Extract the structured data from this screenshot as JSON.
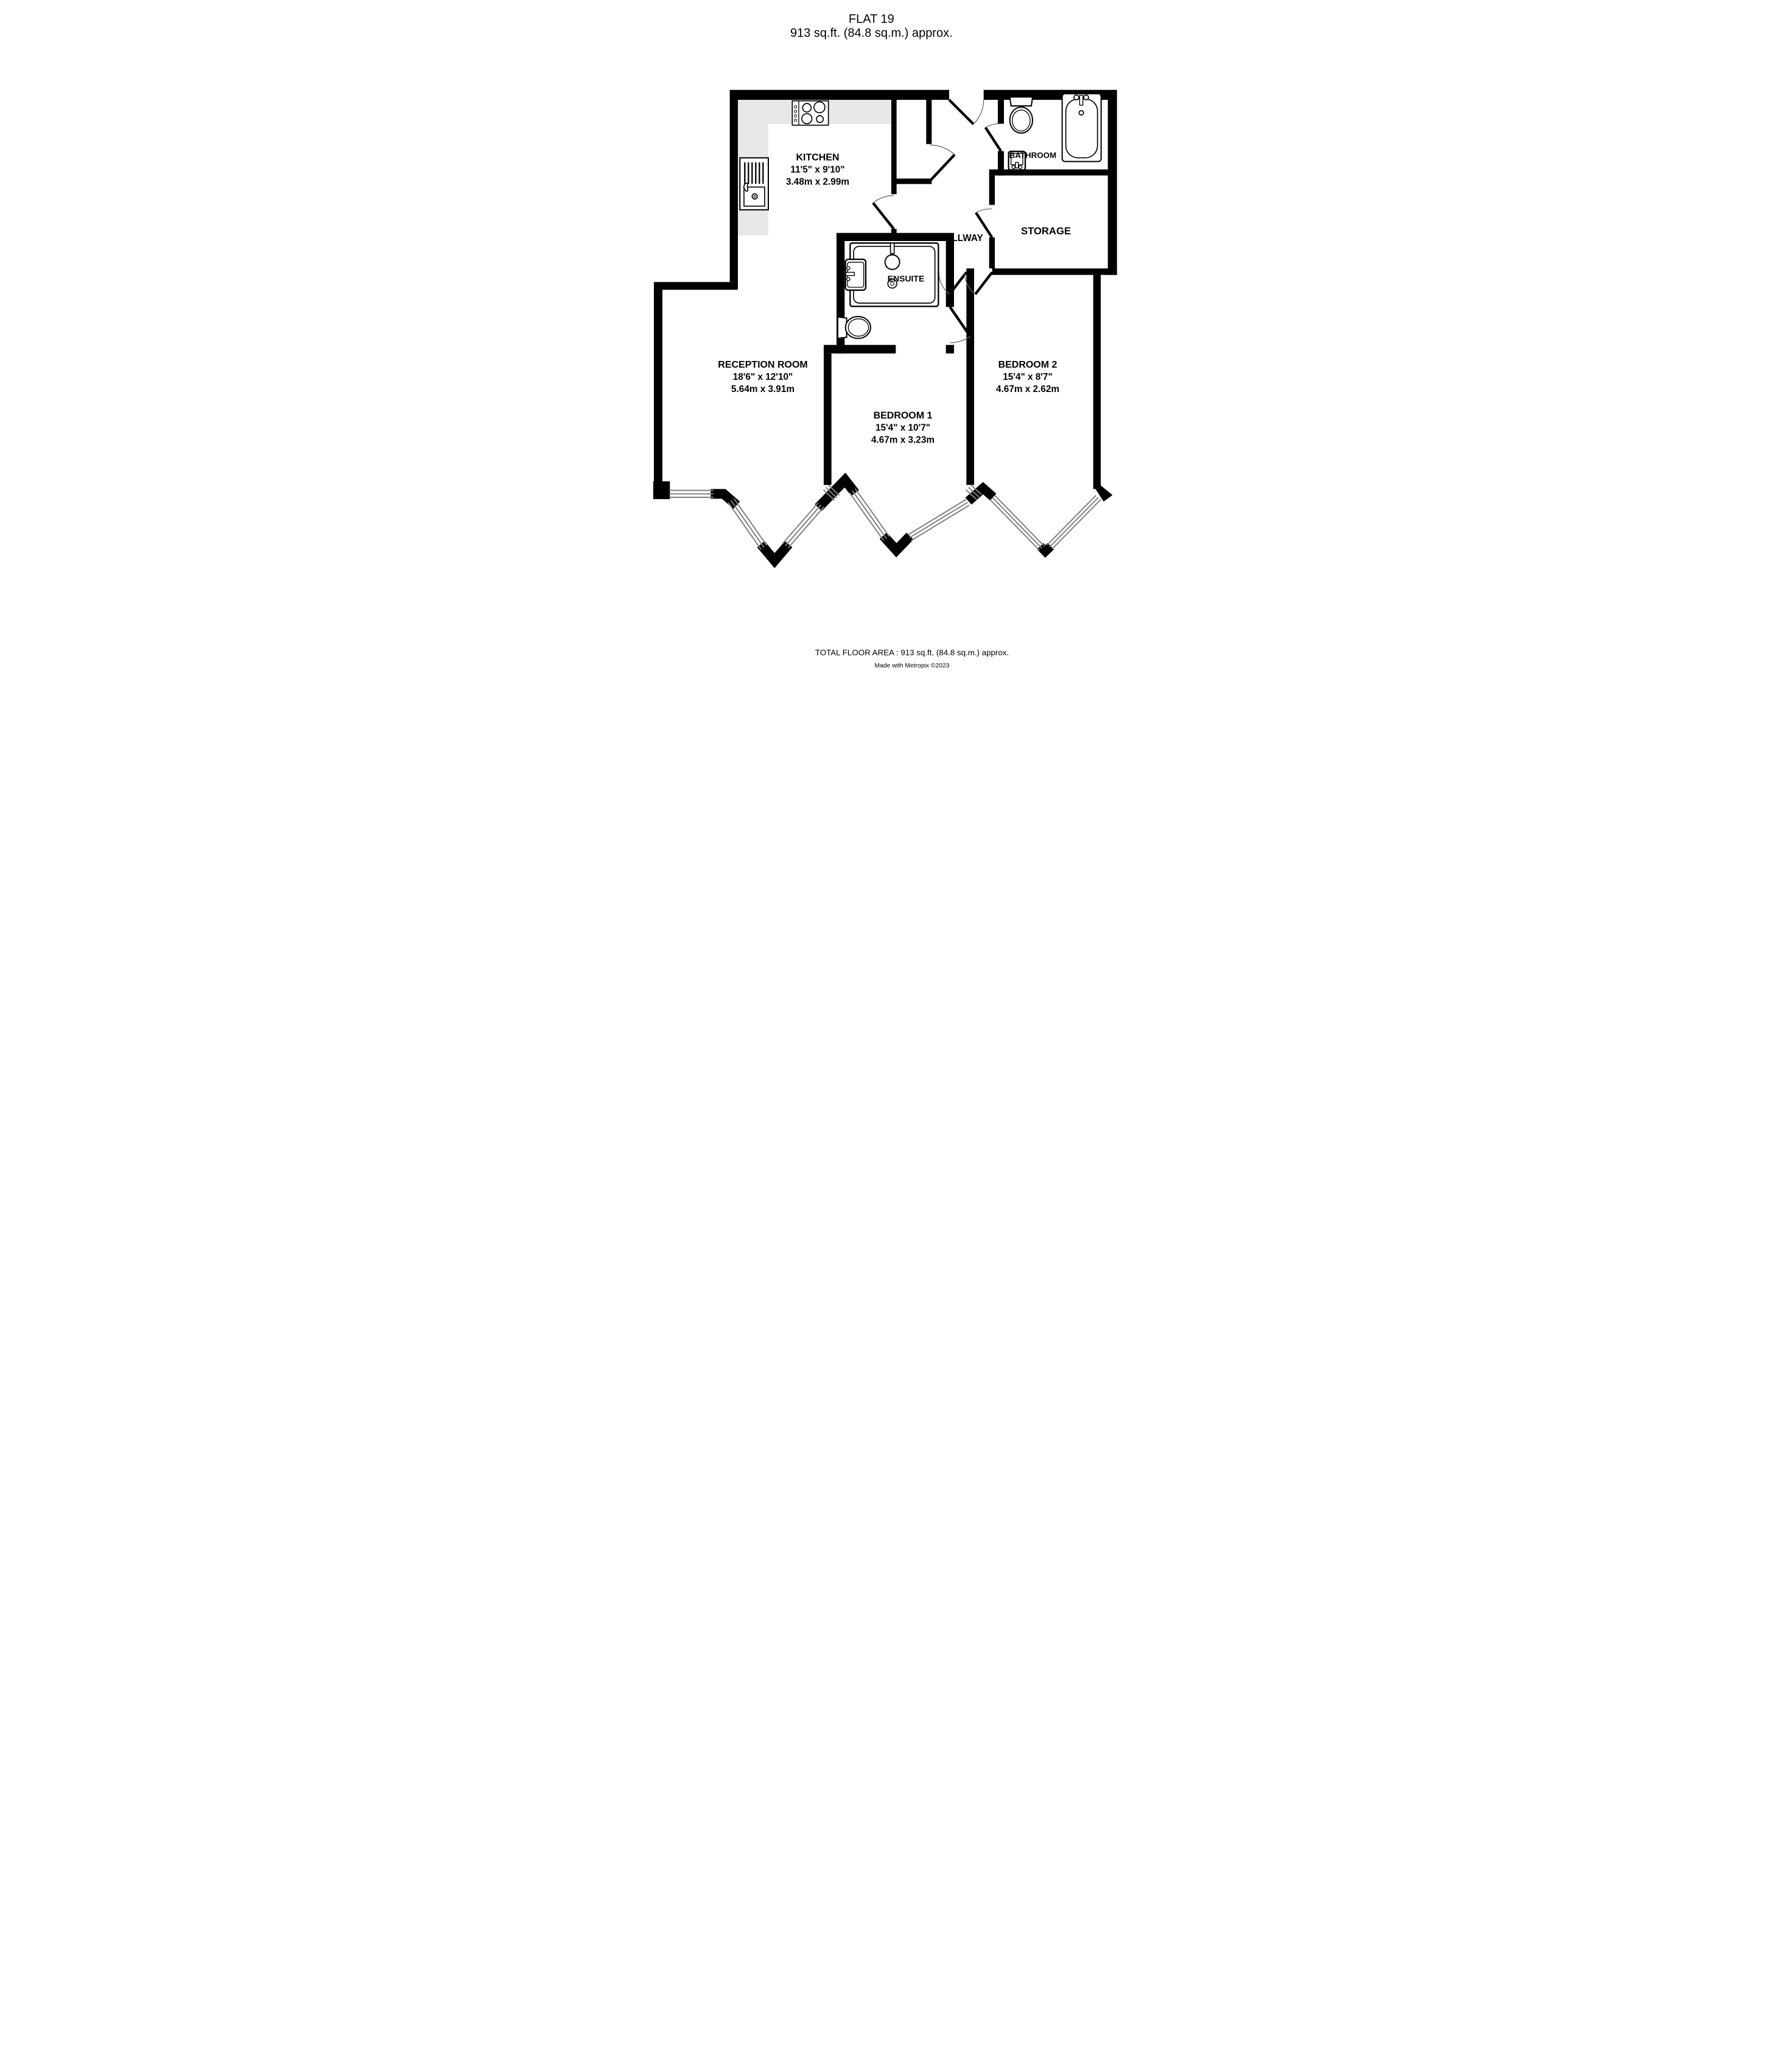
{
  "title": {
    "line1": "FLAT 19",
    "line2": "913 sq.ft. (84.8 sq.m.) approx."
  },
  "rooms": {
    "kitchen": {
      "name": "KITCHEN",
      "dims_imperial": "11'5\"  x 9'10\"",
      "dims_metric": "3.48m  x 2.99m"
    },
    "bathroom": {
      "name": "BATHROOM"
    },
    "hallway": {
      "name": "HALLWAY"
    },
    "storage": {
      "name": "STORAGE"
    },
    "ensuite": {
      "name": "ENSUITE"
    },
    "reception": {
      "name": "RECEPTION ROOM",
      "dims_imperial": "18'6\"  x 12'10\"",
      "dims_metric": "5.64m  x 3.91m"
    },
    "bedroom1": {
      "name": "BEDROOM 1",
      "dims_imperial": "15'4\"  x 10'7\"",
      "dims_metric": "4.67m  x 3.23m"
    },
    "bedroom2": {
      "name": "BEDROOM 2",
      "dims_imperial": "15'4\"  x 8'7\"",
      "dims_metric": "4.67m  x 2.62m"
    }
  },
  "footer": {
    "total_area": "TOTAL FLOOR AREA : 913 sq.ft. (84.8 sq.m.) approx.",
    "credit": "Made with Metropix ©2023"
  },
  "colors": {
    "wall": "#000000",
    "counter": "#e8e8e8",
    "window_line": "#808080",
    "background": "#ffffff"
  }
}
